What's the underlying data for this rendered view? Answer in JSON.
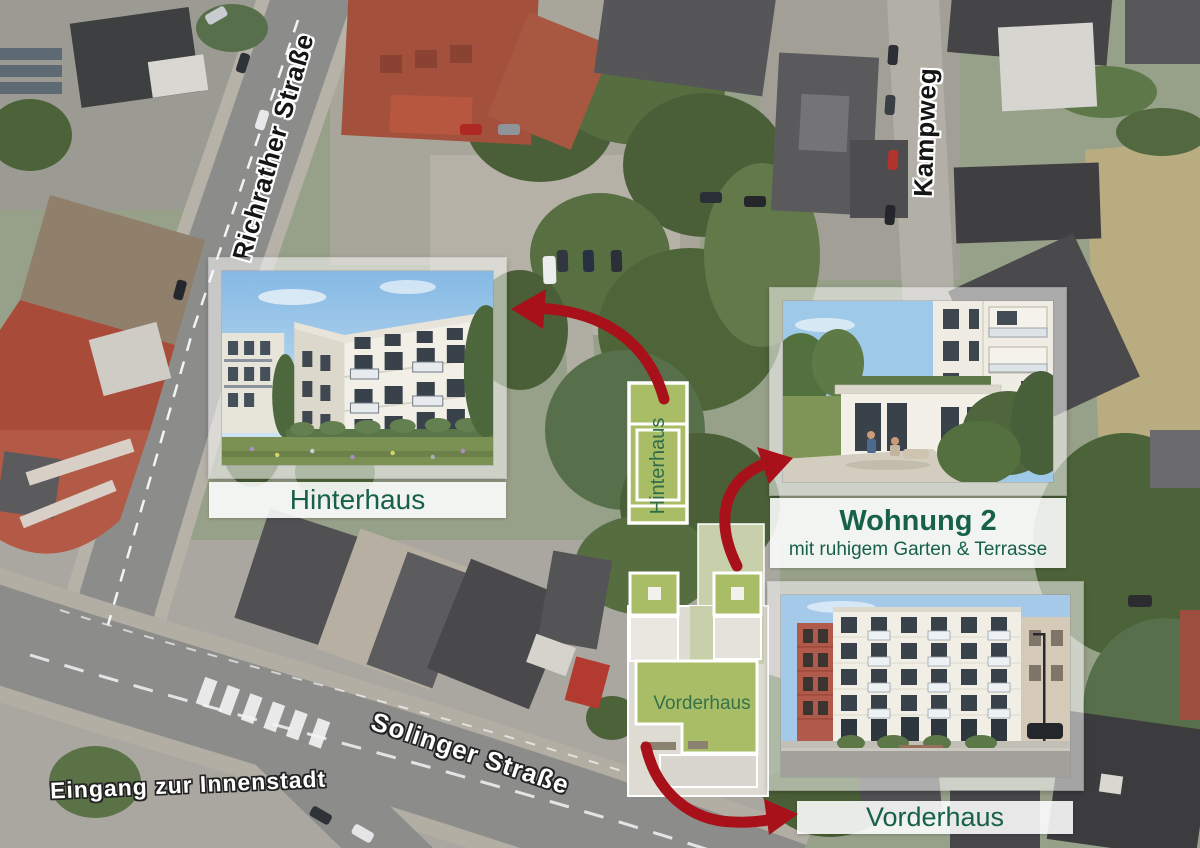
{
  "map": {
    "street_labels": [
      {
        "text": "Richrather Straße"
      },
      {
        "text": "Kampweg"
      },
      {
        "text": "Solinger Straße"
      },
      {
        "text": "Eingang zur Innenstadt"
      }
    ],
    "site_plan": {
      "rear_building_label": "Hinterhaus",
      "front_building_label": "Vorderhaus"
    }
  },
  "insets": {
    "hinterhaus": {
      "label": "Hinterhaus"
    },
    "wohnung2": {
      "title": "Wohnung 2",
      "subtitle": "mit ruhigem Garten & Terrasse"
    },
    "vorderhaus": {
      "label": "Vorderhaus"
    }
  },
  "colors": {
    "label_green": "#176049",
    "siteplan_green": "#a9bd67",
    "siteplan_text_green": "#2f6e48",
    "arrow_red": "#a8111a"
  }
}
